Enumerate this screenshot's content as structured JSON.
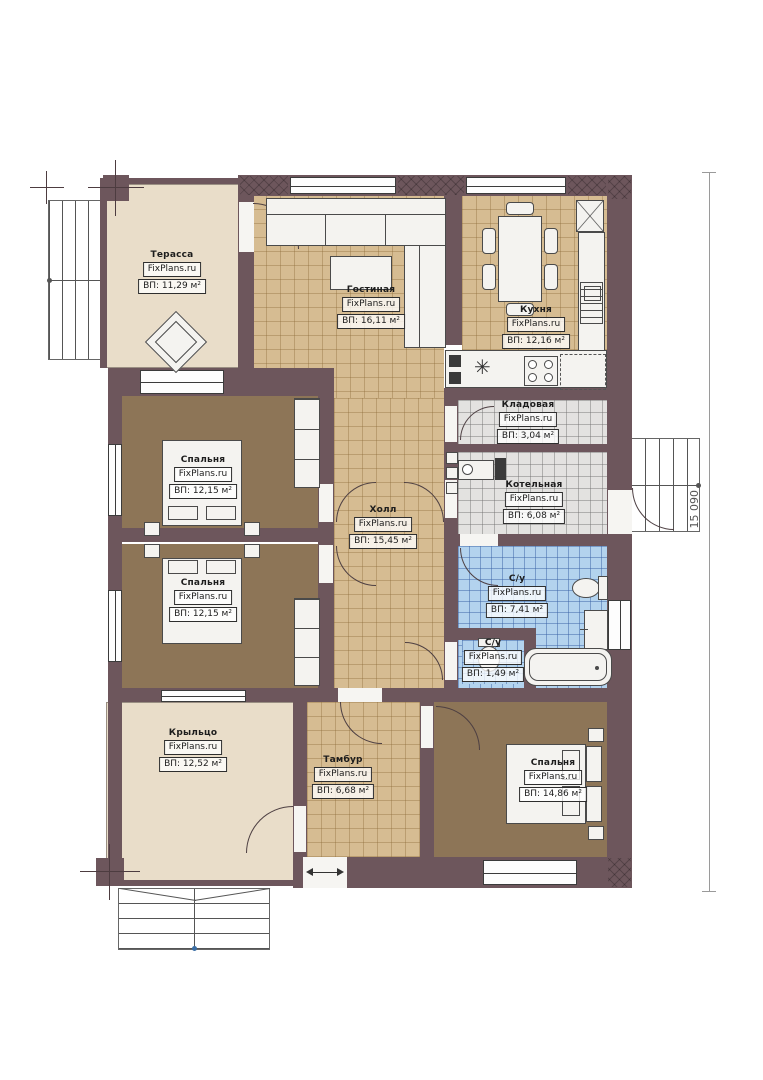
{
  "watermark": "FixPlans.ru",
  "dimension": {
    "right_height": "15 090"
  },
  "rooms": {
    "terrace": {
      "name": "Терасса",
      "area": "ВП: 11,29 м²"
    },
    "living": {
      "name": "Гостиная",
      "area": "ВП: 16,11 м²"
    },
    "kitchen": {
      "name": "Кухня",
      "area": "ВП: 12,16 м²"
    },
    "storage": {
      "name": "Кладовая",
      "area": "ВП: 3,04 м²"
    },
    "boiler": {
      "name": "Котельная",
      "area": "ВП: 6,08 м²"
    },
    "bedroom1": {
      "name": "Спальня",
      "area": "ВП: 12,15 м²"
    },
    "bedroom2": {
      "name": "Спальня",
      "area": "ВП: 12,15 м²"
    },
    "hall": {
      "name": "Холл",
      "area": "ВП: 15,45 м²"
    },
    "bath": {
      "name": "С/у",
      "area": "ВП: 7,41 м²"
    },
    "wc": {
      "name": "С/у",
      "area": "ВП: 1,49 м²"
    },
    "porch": {
      "name": "Крыльцо",
      "area": "ВП: 12,52 м²"
    },
    "vestibule": {
      "name": "Тамбур",
      "area": "ВП: 6,68 м²"
    },
    "bedroom3": {
      "name": "Спальня",
      "area": "ВП: 14,86 м²"
    }
  },
  "colors": {
    "wall": "#6d565c",
    "floor_tan": "#d6bc92",
    "floor_gray": "#e3e2e0",
    "floor_blue": "#b3d3ee",
    "floor_brown": "#8d7557",
    "floor_beige": "#e9ddc9"
  }
}
